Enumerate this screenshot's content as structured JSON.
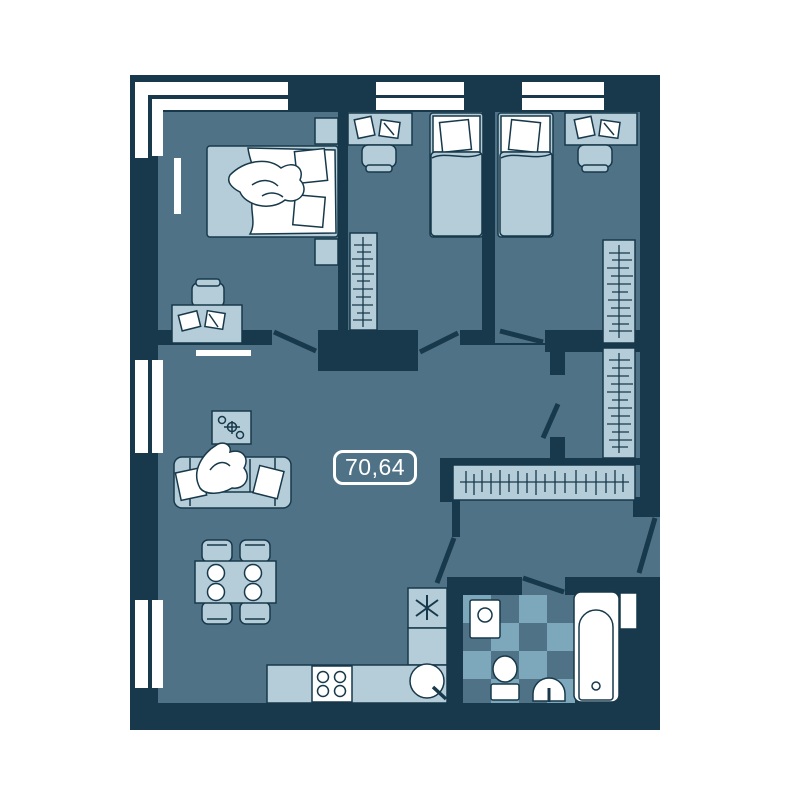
{
  "floorplan": {
    "area_label": "70,64",
    "fridge_symbol": "✳"
  },
  "palette": {
    "background": "#ffffff",
    "wall": "#17394b",
    "floor": "#4f7287",
    "furniture_light": "#b5ccd9",
    "tile_light": "#7da7bb",
    "fixture_white": "#ffffff"
  }
}
